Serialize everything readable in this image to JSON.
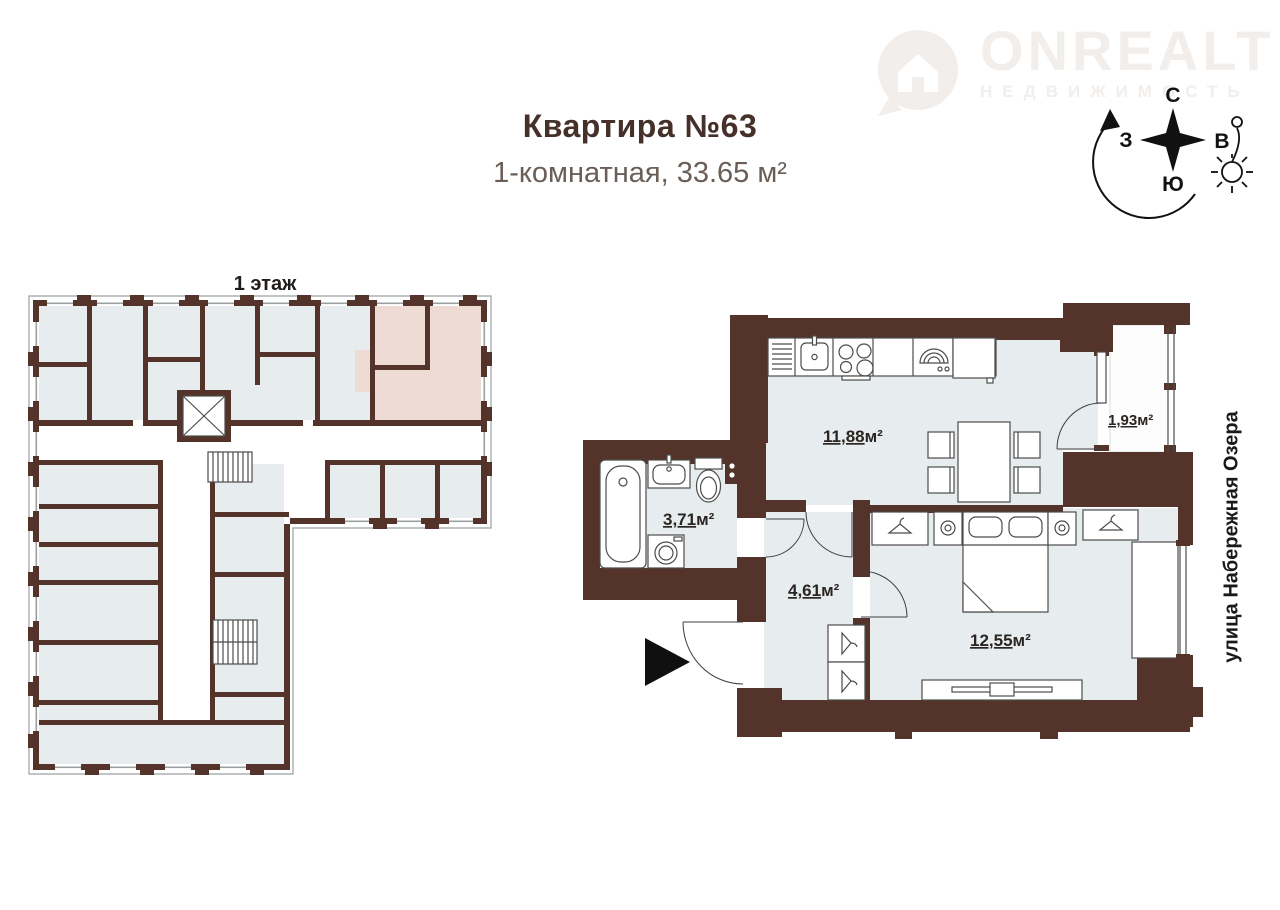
{
  "header": {
    "title": "Квартира №63",
    "subtitle": "1-комнатная, 33.65 м²"
  },
  "brand": {
    "name": "ONREALT",
    "tagline": "НЕДВИЖИМОСТЬ"
  },
  "compass": {
    "north": "С",
    "east": "В",
    "south": "Ю",
    "west": "З"
  },
  "overview": {
    "floor_label": "1 этаж"
  },
  "apartment": {
    "street_label": "улица Набережная Озера",
    "rooms": {
      "kitchen": {
        "name": "кухня-гостиная",
        "area_value": "11,88",
        "area_unit": "м²"
      },
      "loggia": {
        "name": "лоджия",
        "area_value": "1,93",
        "area_unit": "м²"
      },
      "bathroom": {
        "name": "санузел",
        "area_value": "3,71",
        "area_unit": "м²"
      },
      "hallway": {
        "name": "прихожая",
        "area_value": "4,61",
        "area_unit": "м²"
      },
      "bedroom": {
        "name": "спальня",
        "area_value": "12,55",
        "area_unit": "м²"
      }
    }
  },
  "colors": {
    "wall": "#54342a",
    "room_fill": "#e7edee",
    "highlight_fill": "#eedbd3",
    "label_text": "#2b2522",
    "title_text": "#46312a",
    "subtitle_text": "#6a5e57",
    "watermark": "#f1eeec"
  }
}
